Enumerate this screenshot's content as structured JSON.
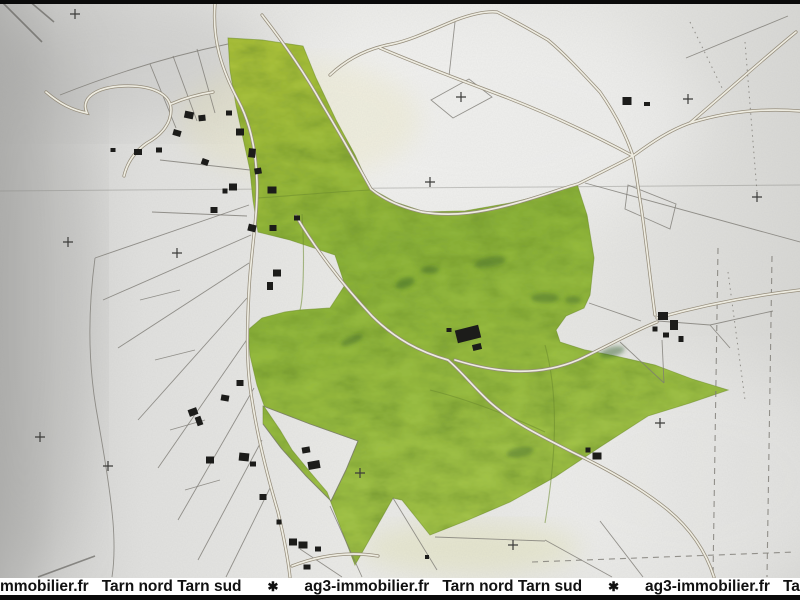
{
  "watermark": {
    "items": [
      "mmobilier.fr",
      "Tarn nord Tarn sud",
      "✱",
      "ag3-immobilier.fr",
      "Tarn nord Tarn sud",
      "✱",
      "ag3-immobilier.fr",
      "Tarn nord Tarn"
    ]
  },
  "colors": {
    "parcel_green": "#9cbf3f",
    "parcel_green_dark": "#6f9c30",
    "paper": "#e4e4e2",
    "building_black": "#1c1c1a",
    "road_casing": "#958d7c",
    "watermark_bg": "#ffffff",
    "watermark_text": "#111111",
    "bar_black": "#0a0a0a"
  },
  "map": {
    "buildings": [
      [
        189,
        115,
        9,
        7,
        12
      ],
      [
        202,
        118,
        7,
        6,
        -6
      ],
      [
        177,
        133,
        8,
        6,
        16
      ],
      [
        240,
        132,
        8,
        7,
        0
      ],
      [
        229,
        113,
        6,
        5,
        0
      ],
      [
        252,
        153,
        7,
        9,
        6
      ],
      [
        138,
        152,
        8,
        6,
        0
      ],
      [
        159,
        150,
        6,
        5,
        0
      ],
      [
        113,
        150,
        5,
        4,
        0
      ],
      [
        205,
        162,
        7,
        6,
        20
      ],
      [
        233,
        187,
        8,
        7,
        0
      ],
      [
        258,
        171,
        7,
        6,
        -10
      ],
      [
        272,
        190,
        9,
        7,
        0
      ],
      [
        225,
        191,
        5,
        5,
        0
      ],
      [
        214,
        210,
        7,
        6,
        0
      ],
      [
        252,
        228,
        8,
        7,
        14
      ],
      [
        273,
        228,
        7,
        6,
        0
      ],
      [
        297,
        218,
        6,
        5,
        0
      ],
      [
        277,
        273,
        8,
        7,
        0
      ],
      [
        270,
        286,
        6,
        8,
        0
      ],
      [
        240,
        383,
        7,
        6,
        0
      ],
      [
        225,
        398,
        8,
        6,
        10
      ],
      [
        193,
        412,
        9,
        7,
        -20
      ],
      [
        199,
        421,
        6,
        9,
        -20
      ],
      [
        210,
        460,
        8,
        7,
        0
      ],
      [
        244,
        457,
        10,
        8,
        6
      ],
      [
        253,
        464,
        6,
        5,
        0
      ],
      [
        263,
        497,
        7,
        6,
        0
      ],
      [
        279,
        522,
        5,
        5,
        0
      ],
      [
        293,
        542,
        8,
        7,
        0
      ],
      [
        307,
        567,
        7,
        5,
        0
      ],
      [
        306,
        450,
        8,
        6,
        -10
      ],
      [
        314,
        465,
        12,
        8,
        -10
      ],
      [
        303,
        545,
        9,
        7,
        0
      ],
      [
        318,
        549,
        6,
        5,
        0
      ],
      [
        427,
        557,
        4,
        4,
        0
      ],
      [
        468,
        334,
        24,
        13,
        -14
      ],
      [
        477,
        347,
        9,
        6,
        -14
      ],
      [
        449,
        330,
        5,
        4,
        0
      ],
      [
        663,
        316,
        10,
        8,
        0
      ],
      [
        674,
        325,
        8,
        10,
        0
      ],
      [
        666,
        335,
        6,
        5,
        0
      ],
      [
        681,
        339,
        5,
        6,
        0
      ],
      [
        655,
        329,
        5,
        5,
        0
      ],
      [
        627,
        101,
        9,
        8,
        0
      ],
      [
        647,
        104,
        6,
        4,
        0
      ],
      [
        597,
        456,
        9,
        7,
        0
      ],
      [
        588,
        450,
        5,
        5,
        0
      ]
    ],
    "crosses": [
      [
        75,
        14
      ],
      [
        461,
        97
      ],
      [
        430,
        182
      ],
      [
        68,
        242
      ],
      [
        177,
        253
      ],
      [
        660,
        423
      ],
      [
        513,
        545
      ],
      [
        108,
        466
      ],
      [
        40,
        437
      ],
      [
        757,
        197
      ],
      [
        688,
        99
      ],
      [
        360,
        473
      ]
    ]
  }
}
